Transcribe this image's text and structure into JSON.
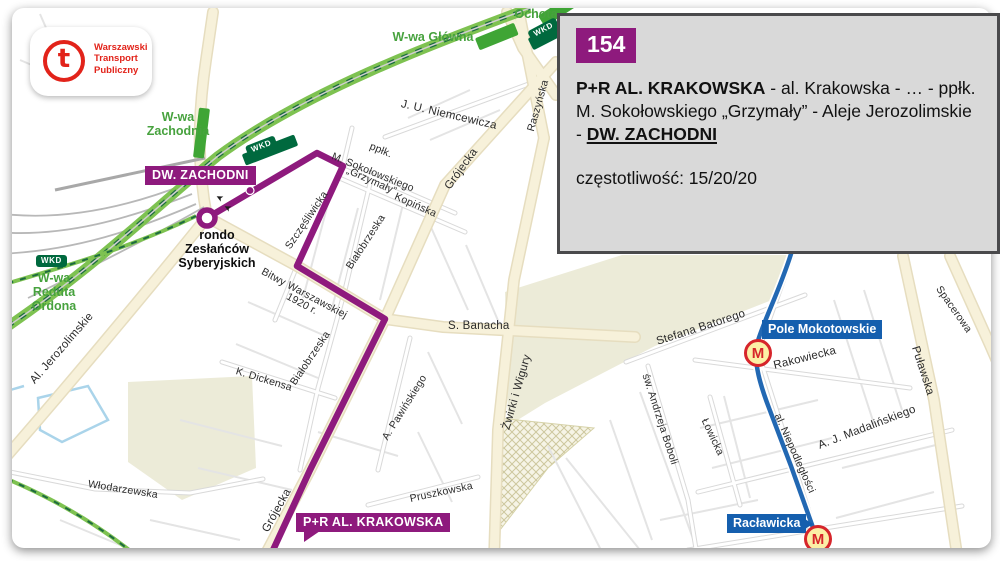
{
  "logo": {
    "glyph": "t",
    "lines": [
      "Warszawski",
      "Transport",
      "Publiczny"
    ]
  },
  "info_panel": {
    "line_number": "154",
    "route": {
      "from": "P+R AL. KRAKOWSKA",
      "middle": " - al. Krakowska - … - ppłk. M. Sokołowskiego „Grzymały” - Aleje Jerozolimskie - ",
      "to": "DW. ZACHODNI"
    },
    "frequency": "częstotliwość: 15/20/20"
  },
  "map": {
    "colors": {
      "line_purple": "#8e1a7d",
      "metro_blue": "#2268b3",
      "metro_badge_blue": "#155fae",
      "station_green": "#3fa535",
      "station_text_green": "#47a23e",
      "wkd_green": "#00693e",
      "panel_bg": "#d9d9d9",
      "panel_border": "#4a4a4c",
      "brand_red": "#e2231a"
    },
    "metro_letter": "M",
    "wkd_text": "WKD",
    "rondo": [
      "rondo",
      "Zesłańców",
      "Syberyjskich"
    ],
    "terminus_badges": [
      {
        "t": "DW. ZACHODNI",
        "x": 145,
        "y": 166,
        "pointer": false
      },
      {
        "t": "P+R AL. KRAKOWSKA",
        "x": 296,
        "y": 513,
        "pointer": true
      }
    ],
    "metro_stations": [
      {
        "name": "Pole Mokotowskie",
        "bx": 762,
        "by": 320,
        "ix": 744,
        "iy": 339,
        "pointer": false
      },
      {
        "name": "Racławicka",
        "bx": 727,
        "by": 514,
        "ix": 804,
        "iy": 525,
        "pointer": true
      }
    ],
    "station_labels": [
      {
        "lines": [
          "W-wa",
          "Zachodnia"
        ],
        "x": 143,
        "y": 110,
        "w": 70
      },
      {
        "lines": [
          "W-wa Główna"
        ],
        "x": 388,
        "y": 30,
        "w": 90
      },
      {
        "lines": [
          "Ochota"
        ],
        "x": 512,
        "y": 7,
        "w": 48
      },
      {
        "lines": [
          "W-wa",
          "Reduta",
          "Ordona"
        ],
        "x": 22,
        "y": 271,
        "w": 64
      }
    ],
    "wkd_badges": [
      {
        "x": 36,
        "y": 255,
        "r": 0
      },
      {
        "x": 247,
        "y": 146,
        "r": -21
      },
      {
        "x": 530,
        "y": 31,
        "r": -28
      }
    ],
    "direction_arrows": [
      {
        "x": 216,
        "y": 193,
        "r": 207
      },
      {
        "x": 224,
        "y": 203,
        "r": 207
      }
    ],
    "street_labels": [
      {
        "t": "Al. Jerozolimskie",
        "x": 33,
        "y": 377,
        "r": -49,
        "s": 11.5
      },
      {
        "t": "Włodarzewska",
        "x": 88,
        "y": 479,
        "r": 9
      },
      {
        "t": "K. Dickensa",
        "x": 236,
        "y": 366,
        "r": 17
      },
      {
        "t": "Białobrzeska",
        "x": 349,
        "y": 263,
        "r": -57
      },
      {
        "t": "Białobrzeska",
        "x": 293,
        "y": 379,
        "r": -56
      },
      {
        "t": "Szczęśliwicka",
        "x": 288,
        "y": 243,
        "r": -56
      },
      {
        "t": "Bitwy Warszawskiej",
        "x": 262,
        "y": 266,
        "r": 28
      },
      {
        "t": "1920 r.",
        "x": 287,
        "y": 291,
        "r": 28
      },
      {
        "t": "ppłk.",
        "x": 370,
        "y": 141,
        "r": 22
      },
      {
        "t": "M. Sokołowskiego",
        "x": 332,
        "y": 151,
        "r": 22
      },
      {
        "t": "„Grzymały”",
        "x": 347,
        "y": 165,
        "r": 24
      },
      {
        "t": "Kopińska",
        "x": 395,
        "y": 191,
        "r": 24
      },
      {
        "t": "J. U. Niemcewicza",
        "x": 401,
        "y": 99,
        "r": 13,
        "s": 11.5
      },
      {
        "t": "Raszyńska",
        "x": 531,
        "y": 126,
        "r": -74
      },
      {
        "t": "Grójecka",
        "x": 448,
        "y": 183,
        "r": -54,
        "s": 11.5
      },
      {
        "t": "Grójecka",
        "x": 266,
        "y": 526,
        "r": -61,
        "s": 11.5
      },
      {
        "t": "S. Banacha",
        "x": 448,
        "y": 321,
        "r": 0,
        "s": 11.5
      },
      {
        "t": "A. Pawińskiego",
        "x": 385,
        "y": 434,
        "r": -58
      },
      {
        "t": "Żwirki i Wigury",
        "x": 507,
        "y": 424,
        "r": -74,
        "s": 11.5
      },
      {
        "t": "Pruszkowska",
        "x": 410,
        "y": 494,
        "r": -12
      },
      {
        "t": "Stefana Batorego",
        "x": 657,
        "y": 337,
        "r": -18,
        "s": 11.5
      },
      {
        "t": "Rakowiecka",
        "x": 774,
        "y": 361,
        "r": -14,
        "s": 11.5
      },
      {
        "t": "Puławska",
        "x": 914,
        "y": 341,
        "r": 72,
        "s": 11.5
      },
      {
        "t": "Spacerowa",
        "x": 938,
        "y": 282,
        "r": 55
      },
      {
        "t": "św. Andrzeja Boboli",
        "x": 645,
        "y": 369,
        "r": 72
      },
      {
        "t": "Łowicka",
        "x": 704,
        "y": 414,
        "r": 65
      },
      {
        "t": "al. Niepodległości",
        "x": 777,
        "y": 409,
        "r": 66
      },
      {
        "t": "A. J. Madalińskiego",
        "x": 819,
        "y": 441,
        "r": -21,
        "s": 11.5
      }
    ]
  }
}
